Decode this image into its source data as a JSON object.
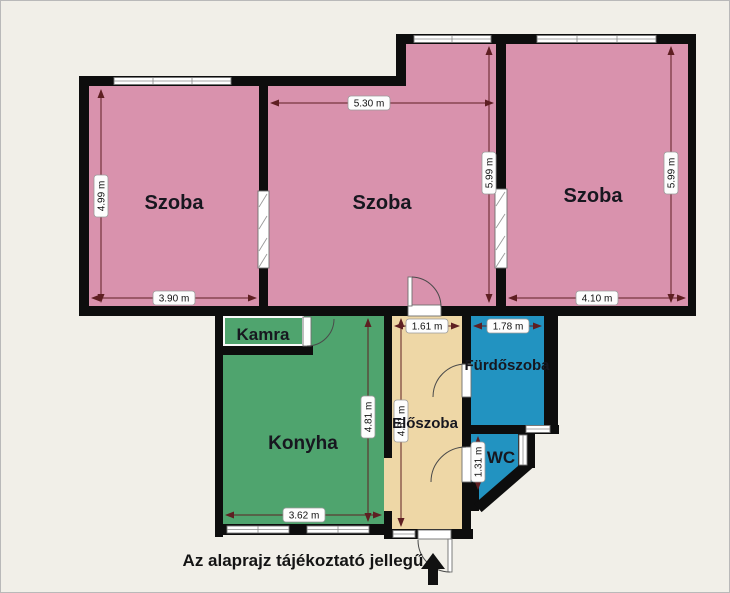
{
  "title": "Alaprajz",
  "note": "Az alaprajz tájékoztató jellegű",
  "rooms": [
    {
      "id": "szoba-left",
      "label": "Szoba",
      "color": "#d992ad"
    },
    {
      "id": "szoba-middle",
      "label": "Szoba",
      "color": "#d992ad"
    },
    {
      "id": "szoba-right",
      "label": "Szoba",
      "color": "#d992ad"
    },
    {
      "id": "kamra",
      "label": "Kamra",
      "color": "#d6d6d6"
    },
    {
      "id": "konyha",
      "label": "Konyha",
      "color": "#4fa46e"
    },
    {
      "id": "eloszoba",
      "label": "Előszoba",
      "color": "#eed7a6"
    },
    {
      "id": "furdoszoba",
      "label": "Fürdőszoba",
      "color": "#2293c1"
    },
    {
      "id": "wc",
      "label": "WC",
      "color": "#2293c1"
    }
  ],
  "dims": {
    "szoba_left_height": "4.99 m",
    "szoba_left_width": "3.90 m",
    "szoba_middle_width": "5.30 m",
    "szoba_middle_height": "5.99 m",
    "szoba_right_height": "5.99 m",
    "szoba_right_width": "4.10 m",
    "konyha_height": "4.81 m",
    "konyha_width": "3.62 m",
    "eloszoba_width": "1.61 m",
    "eloszoba_height": "4.81 m",
    "furdoszoba_width": "1.78 m",
    "wc_height": "1.31 m"
  },
  "colors": {
    "background": "#f1efe8",
    "wall": "#0d0d0d",
    "dimension_line": "#5e1f22",
    "window": "#ffffff"
  },
  "icons": {
    "entrance_arrow": "entrance-arrow"
  }
}
